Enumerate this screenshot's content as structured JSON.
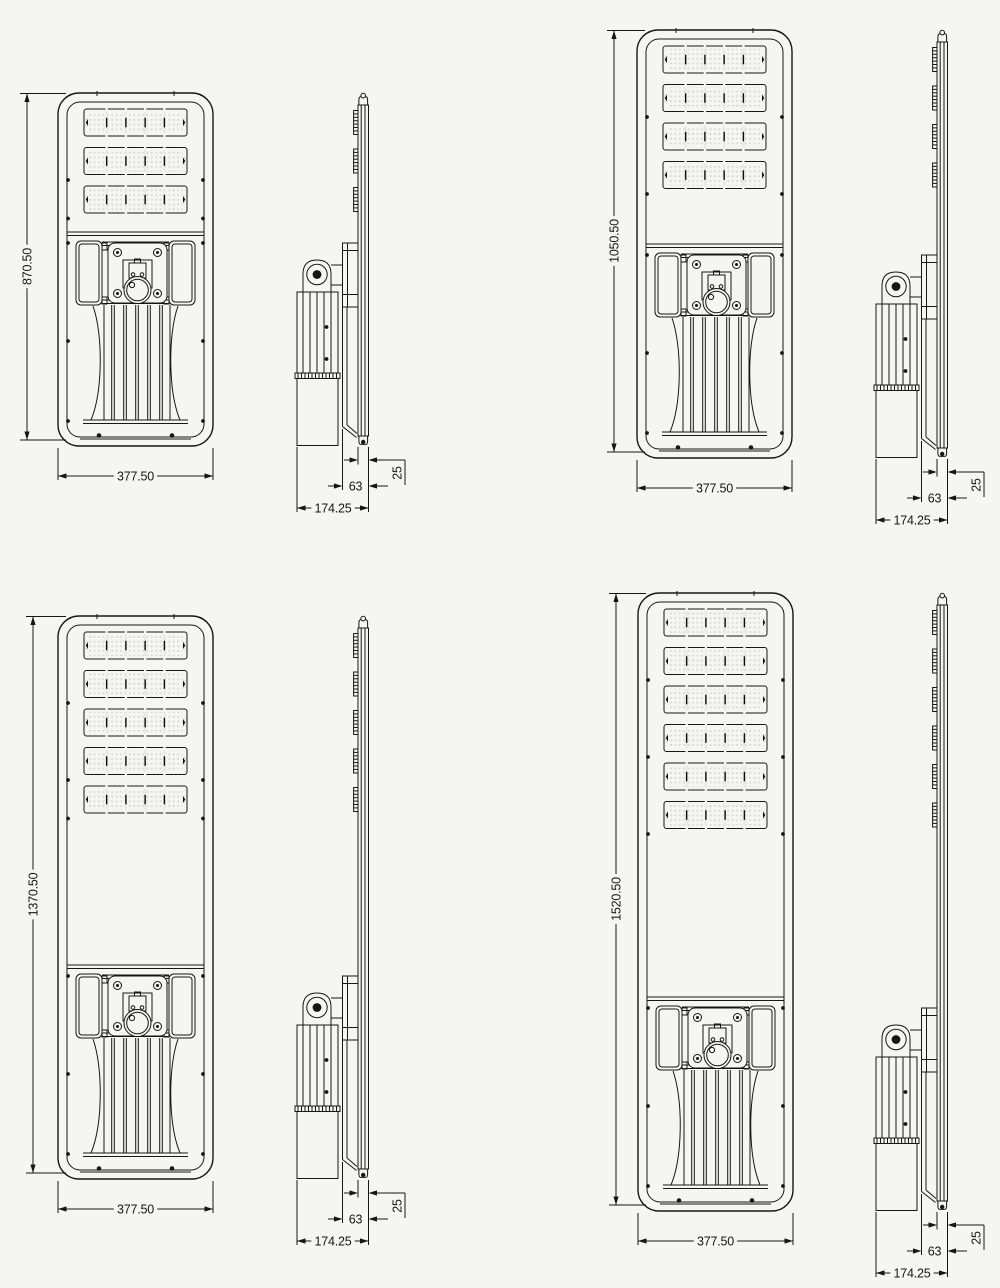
{
  "style": {
    "ink_color": "#161616",
    "background_color": "#f5f5f3",
    "led_panel_color": "#0c0c0c",
    "led_dot_color": "#d8d8d8",
    "module_gap_color": "#e8e8e8"
  },
  "units": [
    {
      "id": "streetlight-870",
      "front": {
        "height_label": "870.50",
        "width_label": "377.50",
        "led_rows": 3
      },
      "side": {
        "depth_label": "174.25",
        "offset_label": "63",
        "thickness_label": "25"
      }
    },
    {
      "id": "streetlight-1050",
      "front": {
        "height_label": "1050.50",
        "width_label": "377.50",
        "led_rows": 4
      },
      "side": {
        "depth_label": "174.25",
        "offset_label": "63",
        "thickness_label": "25"
      }
    },
    {
      "id": "streetlight-1370",
      "front": {
        "height_label": "1370.50",
        "width_label": "377.50",
        "led_rows": 5
      },
      "side": {
        "depth_label": "174.25",
        "offset_label": "63",
        "thickness_label": "25"
      }
    },
    {
      "id": "streetlight-1520",
      "front": {
        "height_label": "1520.50",
        "width_label": "377.50",
        "led_rows": 6
      },
      "side": {
        "depth_label": "174.25",
        "offset_label": "63",
        "thickness_label": "25"
      }
    }
  ]
}
